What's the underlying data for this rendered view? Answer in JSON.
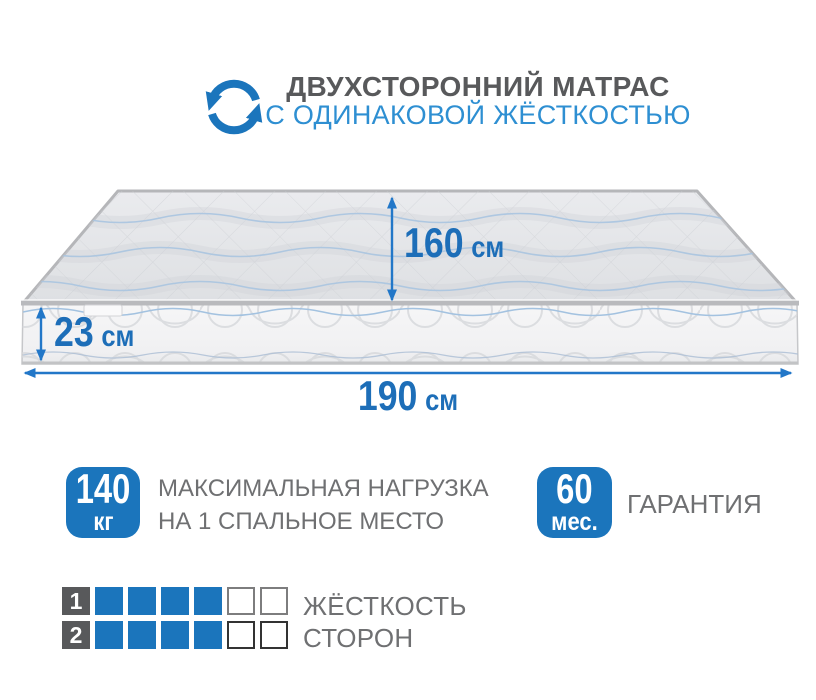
{
  "colors": {
    "accent_blue": "#1b75bc",
    "dimension_blue": "#1d6eb8",
    "arrow_blue": "#2277c8",
    "subtitle_blue": "#2e8fd2",
    "title_gray": "#58595b",
    "text_gray": "#6f7072",
    "cell_number_bg": "#58595b",
    "empty_cell_border_row1": "#7d7d7e",
    "empty_cell_border_row2": "#333333"
  },
  "icons": {
    "header_icon": "two-sided-rotate-icon",
    "dimension_arrows": "double-headed-arrow"
  },
  "header": {
    "title": "ДВУХСТОРОННИЙ МАТРАС",
    "subtitle": "С ОДИНАКОВОЙ ЖЁСТКОСТЬЮ"
  },
  "mattress": {
    "top_dimension": {
      "value": "160",
      "unit": "см"
    },
    "side_height": {
      "value": "23",
      "unit": "см"
    },
    "front_width": {
      "value": "190",
      "unit": "см"
    }
  },
  "badges": {
    "max_load": {
      "value": "140",
      "unit": "кг",
      "label_line1": "МАКСИМАЛЬНАЯ НАГРУЗКА",
      "label_line2": "НА 1 СПАЛЬНОЕ МЕСТО"
    },
    "warranty": {
      "value": "60",
      "unit": "мес.",
      "label": "ГАРАНТИЯ"
    }
  },
  "firmness_scale": {
    "rows": [
      {
        "number": "1",
        "filled": 4,
        "empty": 2
      },
      {
        "number": "2",
        "filled": 4,
        "empty": 2
      }
    ],
    "label_line1": "ЖЁСТКОСТЬ",
    "label_line2": "СТОРОН"
  }
}
